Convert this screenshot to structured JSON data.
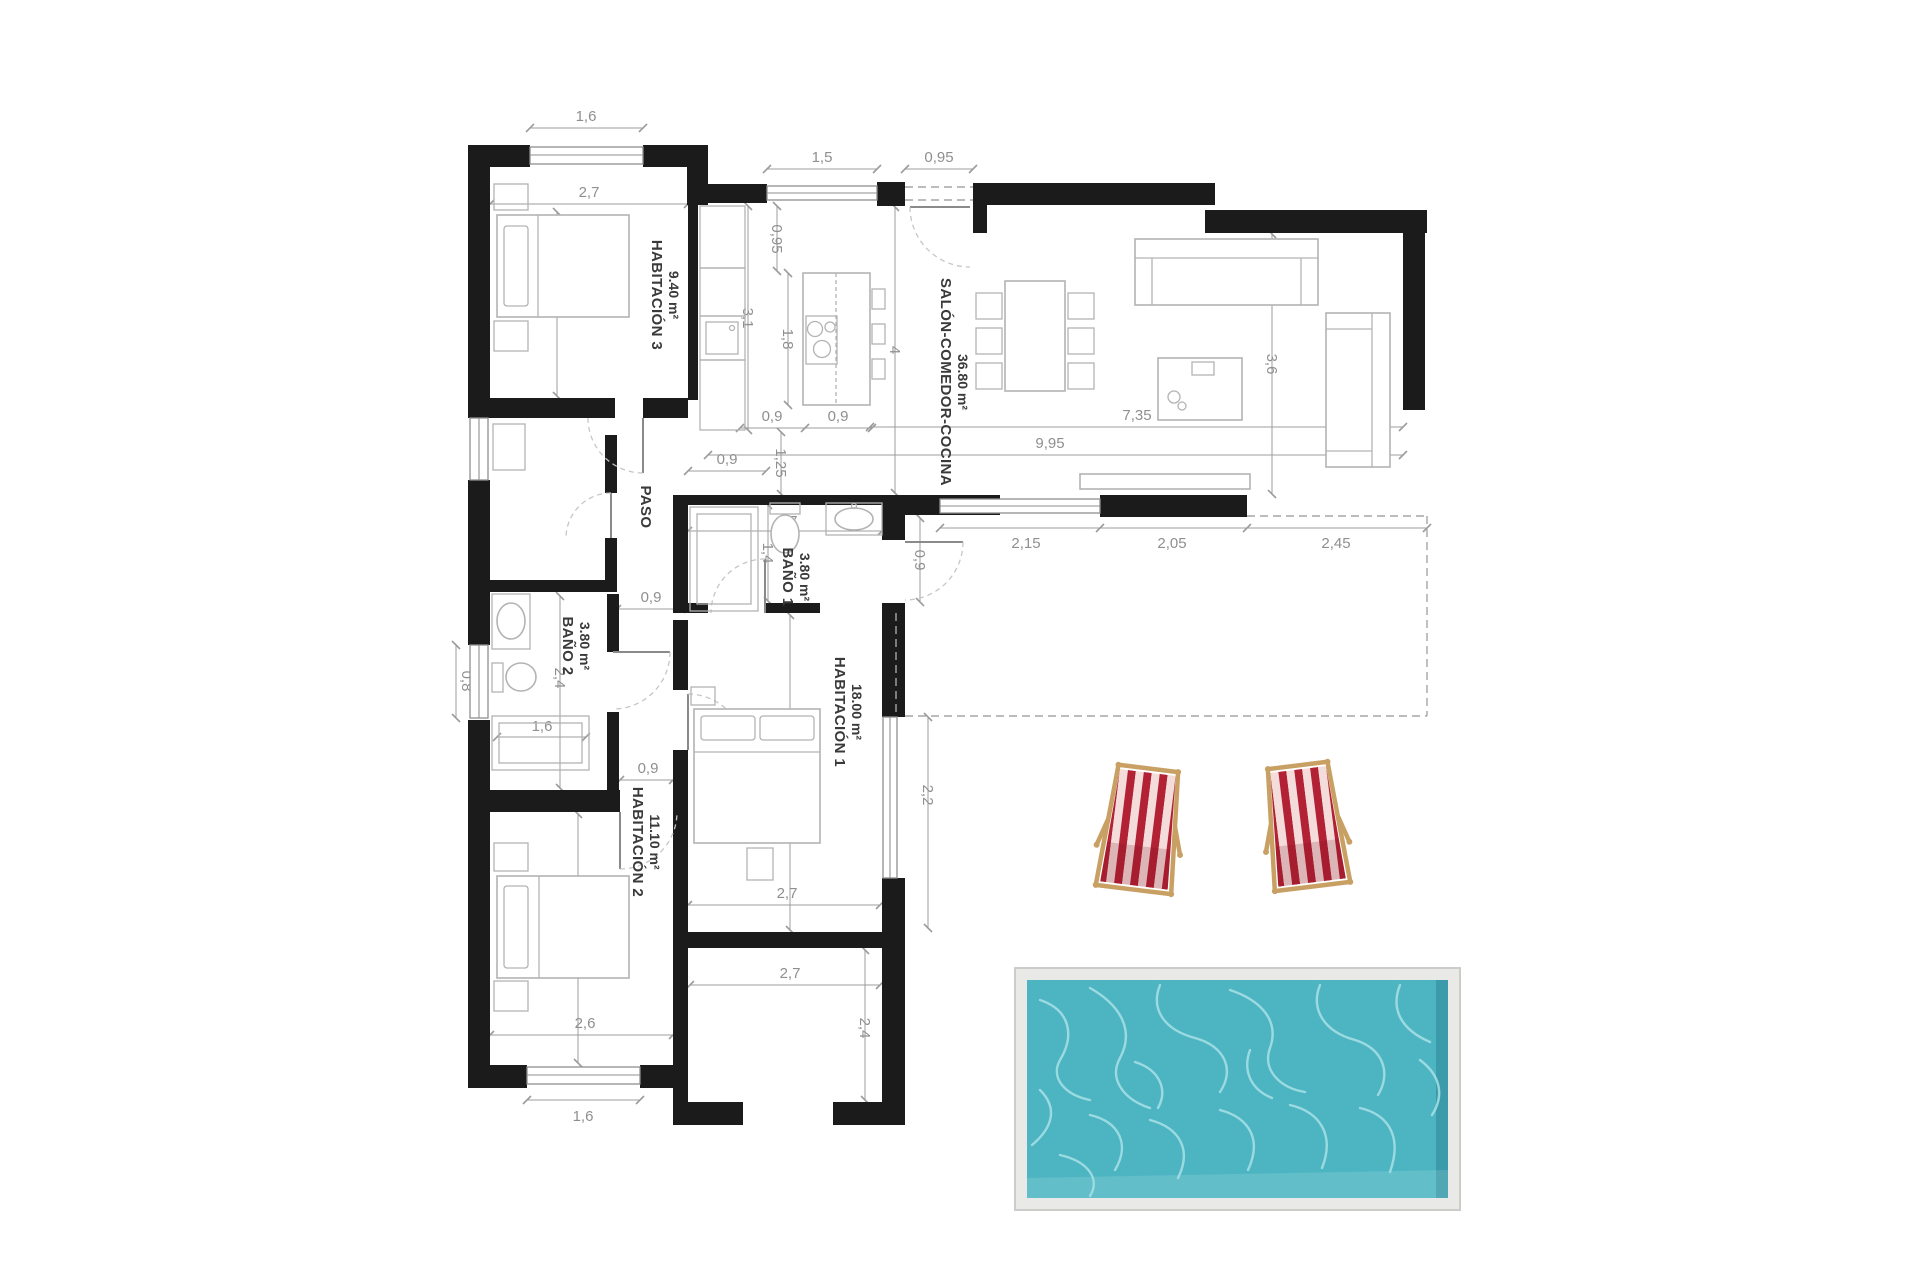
{
  "plan": {
    "rooms": {
      "habitacion3": {
        "label": "HABITACIÓN 3",
        "area": "9.40 m²"
      },
      "salon": {
        "label": "SALÓN-COMEDOR-COCINA",
        "area": "36.80 m²"
      },
      "paso": {
        "label": "PASO"
      },
      "bano1": {
        "label": "BAÑO 1",
        "area": "3.80 m²"
      },
      "bano2": {
        "label": "BAÑO 2",
        "area": "3.80 m²"
      },
      "habitacion1": {
        "label": "HABITACIÓN 1",
        "area": "18.00 m²"
      },
      "habitacion2": {
        "label": "HABITACIÓN 2",
        "area": "11.10 m²"
      }
    },
    "dimensions": {
      "hab3_window_top": "1,6",
      "hab3_width": "2,7",
      "hab3_depth": "3,5",
      "kitchen_window": "1,5",
      "entry_opening": "0,95",
      "kitchen_depth_upper": "0,95",
      "kitchen_counter": "3,1",
      "kitchen_island": "1,8",
      "kitchen_below_left": "0,9",
      "kitchen_below_island": "0,9",
      "passage_kitchen": "1,25",
      "salon_depth_left": "4",
      "salon_length": "9,95",
      "salon_inner_length": "7,35",
      "salon_depth_right": "3,6",
      "terrace_door": "2,15",
      "terrace_window": "2,05",
      "terrace_open": "2,45",
      "terrace_offset": "0,9",
      "terrace_side": "2,2",
      "paso_upper": "0,9",
      "paso_lower": "0,9",
      "bano1_width": "2,7",
      "bano1_depth": "1,4",
      "bano2_window": "0,8",
      "bano2_depth": "2,4",
      "bano2_shower": "1,6",
      "hab2_door": "0,9",
      "hab1_length": "4,49",
      "hab1_width": "2,7",
      "porch_width": "2,7",
      "porch_depth": "2,4",
      "hab2_depth": "3,82",
      "hab2_width": "2,6",
      "hab2_window_bottom": "1,6"
    },
    "colors": {
      "wall": "#1b1b1b",
      "dim": "#8f8f8f",
      "dim_line": "#9c9c9c",
      "label": "#3a3a3a",
      "furniture": "#b3b3b3",
      "pool_water": "#4db5c2",
      "pool_water_deep": "#3a98a8",
      "pool_water_light": "#a9e1e6",
      "pool_frame": "#e9e9e7",
      "pool_frame_border": "#cccccb",
      "chair_stripe": "#b22234",
      "chair_stripe_light": "#f4dcda",
      "chair_frame": "#c9a063"
    }
  }
}
